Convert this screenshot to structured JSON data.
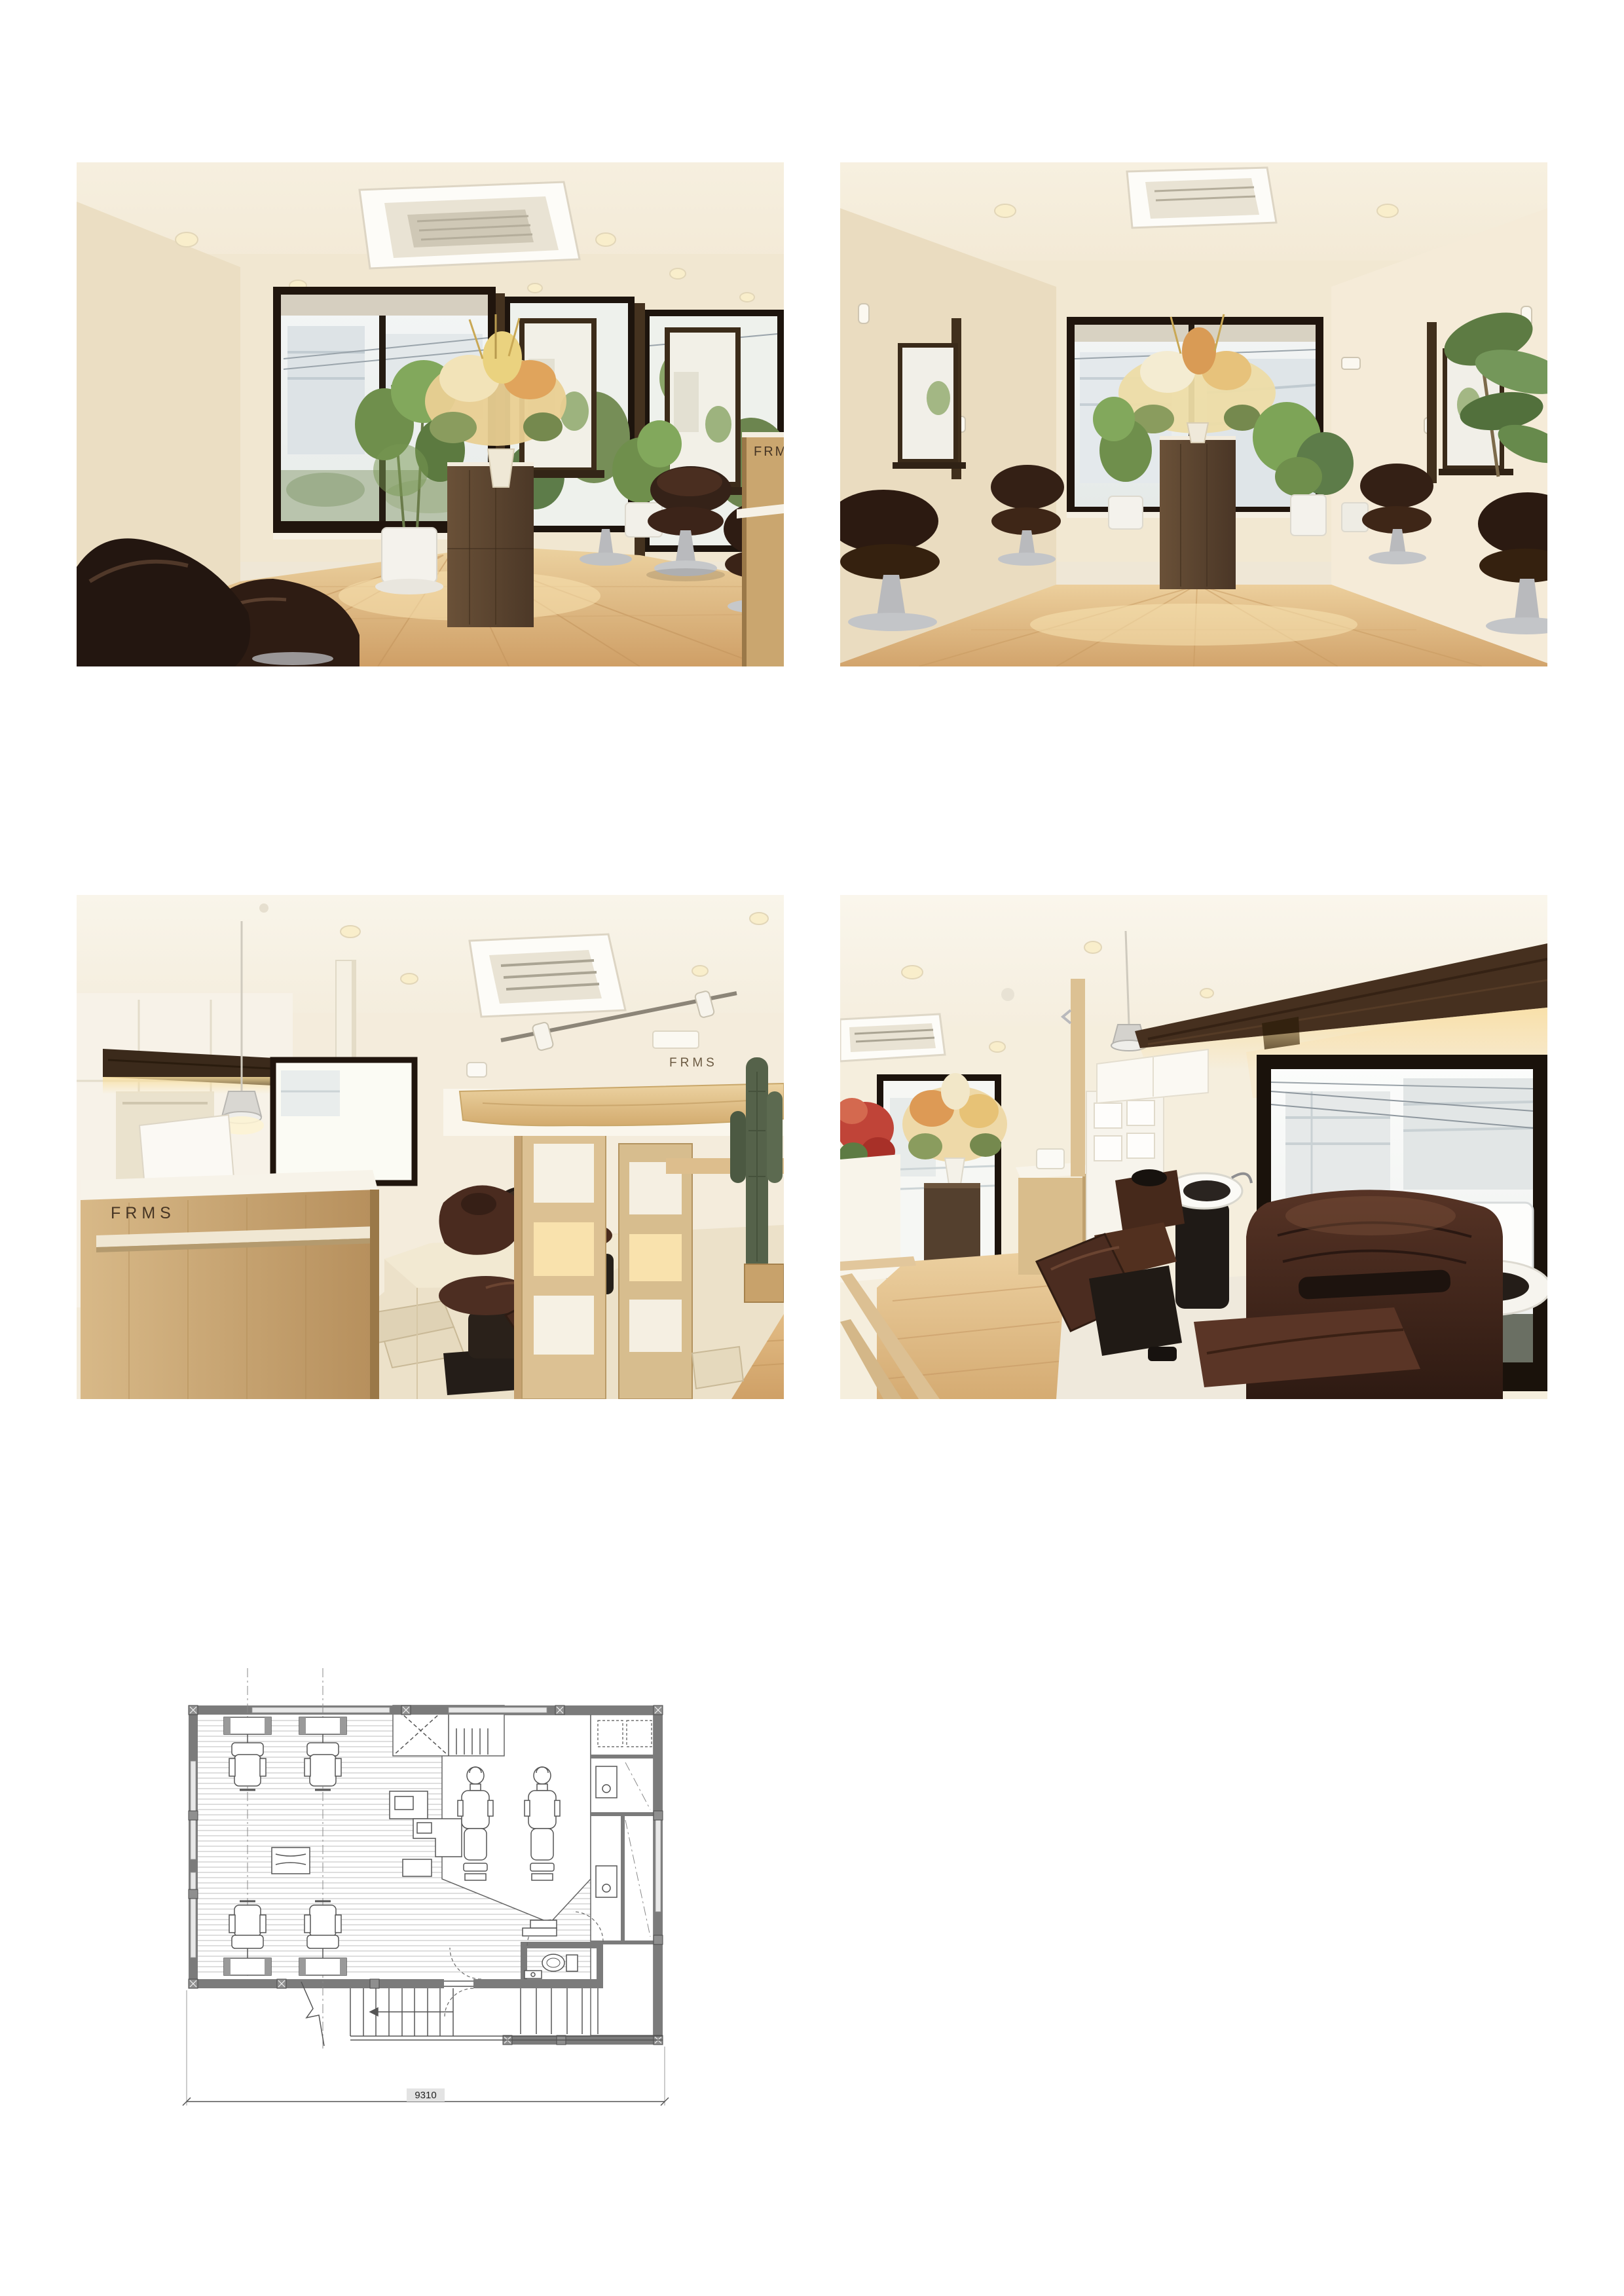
{
  "branding": {
    "logo": "FRMS"
  },
  "photos": {
    "p1": {
      "counter_logo": "FRMS"
    },
    "p3": {
      "desk_logo": "FRMS",
      "wall_logo": "FRMS"
    }
  },
  "floor_plan": {
    "width_dimension": "9310"
  },
  "palette": {
    "page_bg": "#ffffff",
    "wall_cream": "#f0e6d0",
    "ceiling_cream": "#f8f3e7",
    "window_frame": "#241b12",
    "floor_wood": "#ddb87f",
    "cabinet_walnut": "#5d4732",
    "chair_leather": "#38231a",
    "plant_green": "#5f7c44",
    "plan_wall_gray": "#7b7b7b",
    "plan_line_gray": "#4f4f4f"
  }
}
